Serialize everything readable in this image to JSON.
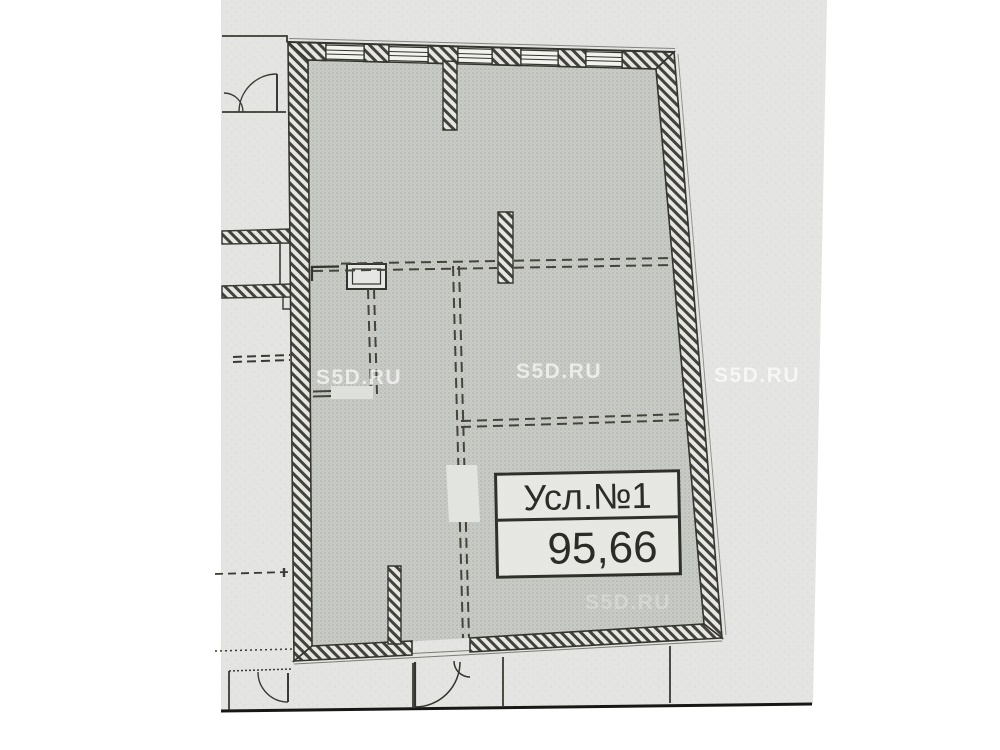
{
  "document": {
    "type": "scanned-floor-plan-photo"
  },
  "label_box": {
    "title": "Усл.№1",
    "area": "95,66"
  },
  "watermarks": {
    "w1": "S5D.RU",
    "w2": "S5D.RU",
    "w3": "S5D.RU",
    "w4": "S5D.RU"
  },
  "colors": {
    "paper": "#e4e5e2",
    "room_fill": "#c9ccc6",
    "ink": "#3a3a34",
    "watermark": "rgba(255,255,255,0.66)"
  }
}
